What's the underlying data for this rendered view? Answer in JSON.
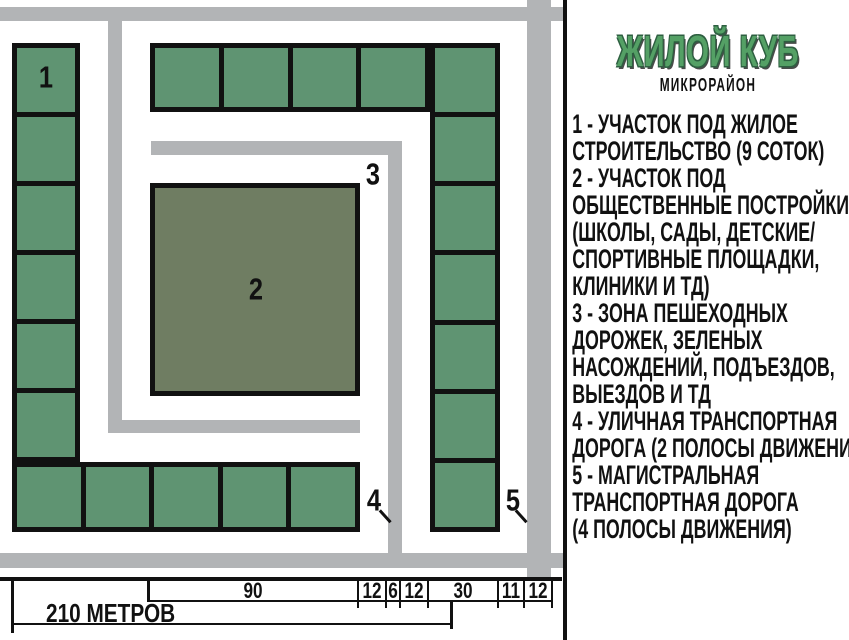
{
  "legend": {
    "title": "ЖИЛОЙ КУБ",
    "subtitle": "МИКРОРАЙОН",
    "separator": "-",
    "items": [
      {
        "num": "1",
        "lines": [
          "УЧАСТОК ПОД ЖИЛОЕ",
          "СТРОИТЕЛЬСТВО (9 СОТОК)"
        ]
      },
      {
        "num": "2",
        "lines": [
          "УЧАСТОК ПОД",
          "ОБЩЕСТВЕННЫЕ ПОСТРОЙКИ",
          "(ШКОЛЫ, САДЫ, ДЕТСКИЕ/",
          "СПОРТИВНЫЕ ПЛОЩАДКИ,",
          "КЛИНИКИ И ТД)"
        ]
      },
      {
        "num": "3",
        "lines": [
          "ЗОНА ПЕШЕХОДНЫХ",
          "ДОРОЖЕК, ЗЕЛЕНЫХ",
          "НАСОЖДЕНИЙ, ПОДЪЕЗДОВ,",
          "ВЫЕЗДОВ И ТД"
        ]
      },
      {
        "num": "4",
        "lines": [
          "УЛИЧНАЯ ТРАНСПОРТНАЯ",
          "ДОРОГА (2 ПОЛОСЫ ДВИЖЕНИЯ)"
        ]
      },
      {
        "num": "5",
        "lines": [
          "МАГИСТРАЛЬНАЯ",
          "ТРАНСПОРТНАЯ ДОРОГА",
          "(4 ПОЛОСЫ ДВИЖЕНИЯ)"
        ]
      }
    ]
  },
  "map": {
    "zone_labels": [
      "1",
      "2",
      "3",
      "4",
      "5"
    ],
    "plot_counts": {
      "left_column": 6,
      "top_row": 4,
      "right_column": 7,
      "bottom_row": 5
    }
  },
  "scale": {
    "total_label": "210 МЕТРОВ",
    "segments": [
      90,
      12,
      6,
      12,
      30,
      11,
      12
    ]
  },
  "colors": {
    "plot_green": "#5f9472",
    "public_green": "#6f7d62",
    "road_gray": "#b2b4b6",
    "title_green": "#54a065",
    "ink": "#111111"
  }
}
